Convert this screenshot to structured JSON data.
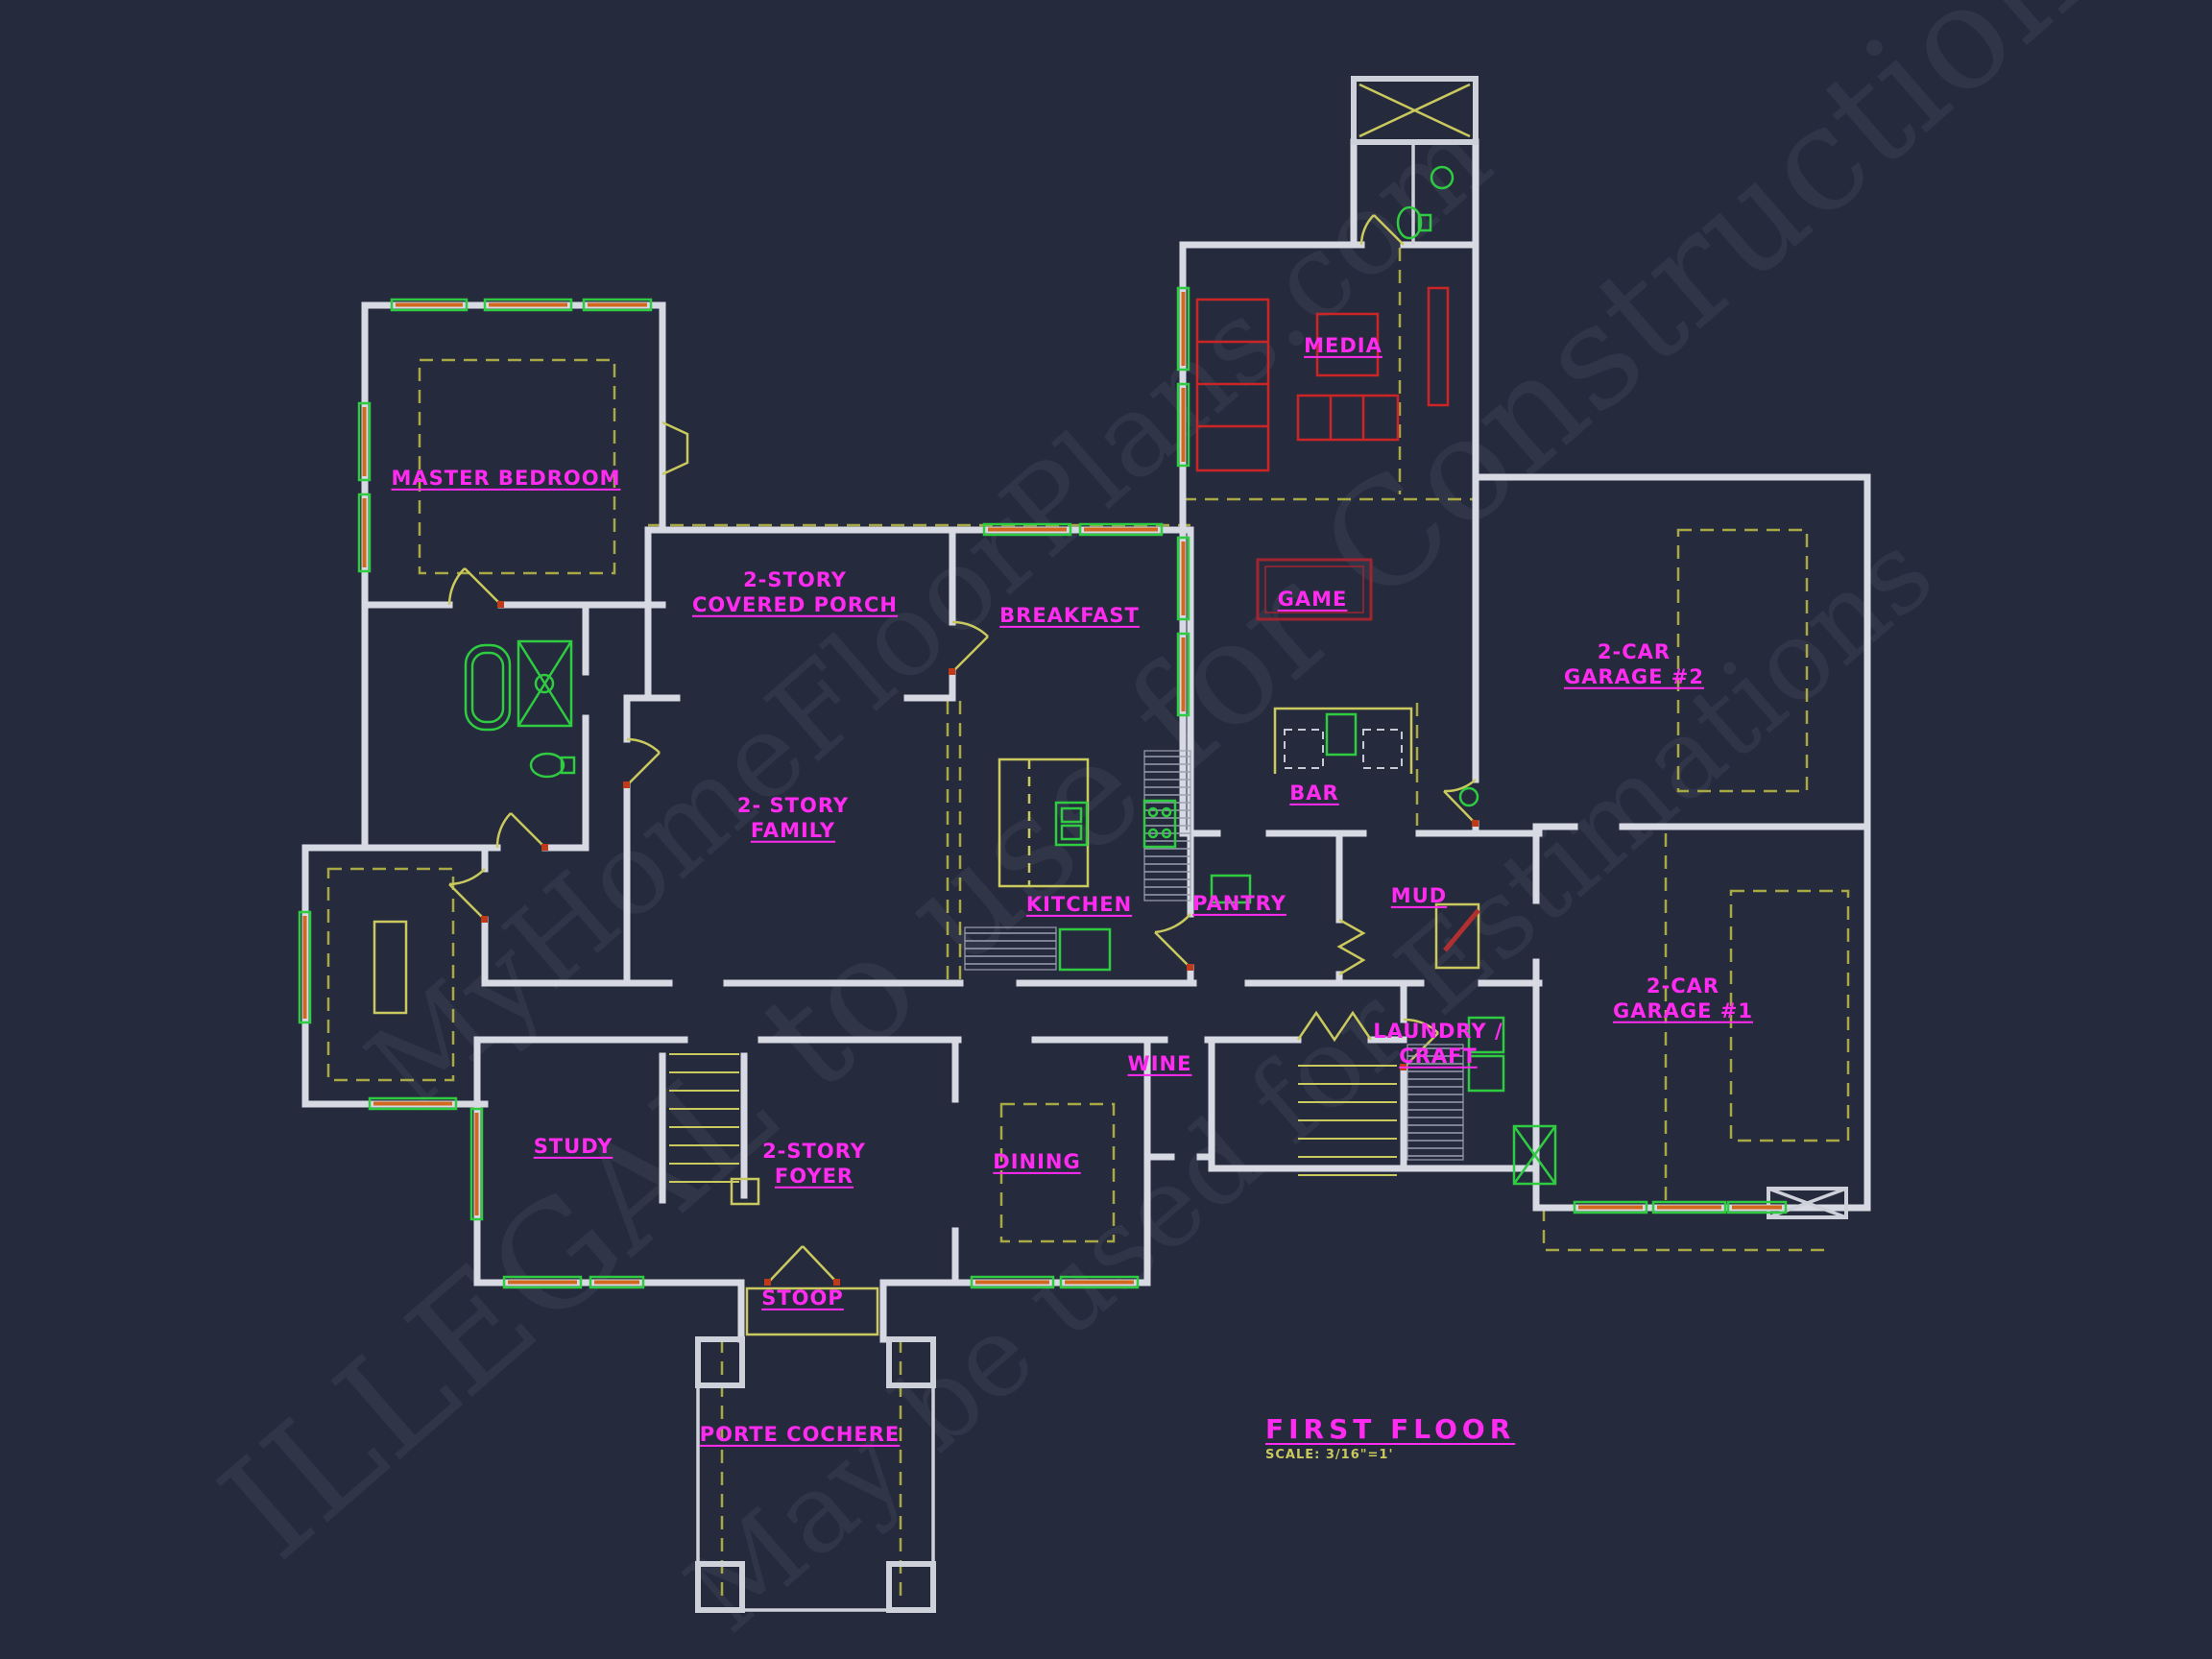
{
  "plan": {
    "title": "FIRST FLOOR",
    "scale_note": "SCALE: 3/16\"=1'"
  },
  "watermark": {
    "line1": "MyHomeFloorPlans.com",
    "line2": "ILLEGAL to use for Construction",
    "line3": "May be used for Estimations"
  },
  "colors": {
    "background": "#262a3d",
    "walls": "#d8dae3",
    "label_magenta": "#ff2bf0",
    "annotation_yellow": "#b9b94a",
    "door_yellow": "#c9c95e",
    "window_green": "#2ecc40",
    "window_orange": "#d2691e",
    "furniture_red": "#cc2525",
    "pool_table_red": "#a02530",
    "fixture_green": "#2ecc40"
  },
  "rooms": {
    "master_bedroom": {
      "label": "MASTER BEDROOM"
    },
    "covered_porch": {
      "line1": "2-STORY",
      "line2": "COVERED PORCH"
    },
    "breakfast": {
      "label": "BREAKFAST"
    },
    "media": {
      "label": "MEDIA"
    },
    "game": {
      "label": "GAME"
    },
    "bar": {
      "label": "BAR"
    },
    "garage2": {
      "line1": "2-CAR",
      "line2": "GARAGE #2"
    },
    "garage1": {
      "line1": "2-CAR",
      "line2": "GARAGE #1"
    },
    "kitchen": {
      "label": "KITCHEN"
    },
    "pantry": {
      "label": "PANTRY"
    },
    "mud": {
      "label": "MUD"
    },
    "family": {
      "line1": "2- STORY",
      "line2": "FAMILY"
    },
    "study": {
      "label": "STUDY"
    },
    "foyer": {
      "line1": "2-STORY",
      "line2": "FOYER"
    },
    "dining": {
      "label": "DINING"
    },
    "wine": {
      "label": "WINE"
    },
    "laundry": {
      "line1": "LAUNDRY /",
      "line2": "CRAFT"
    },
    "stoop": {
      "label": "STOOP"
    },
    "porte_cochere": {
      "label": "PORTE COCHERE"
    }
  }
}
